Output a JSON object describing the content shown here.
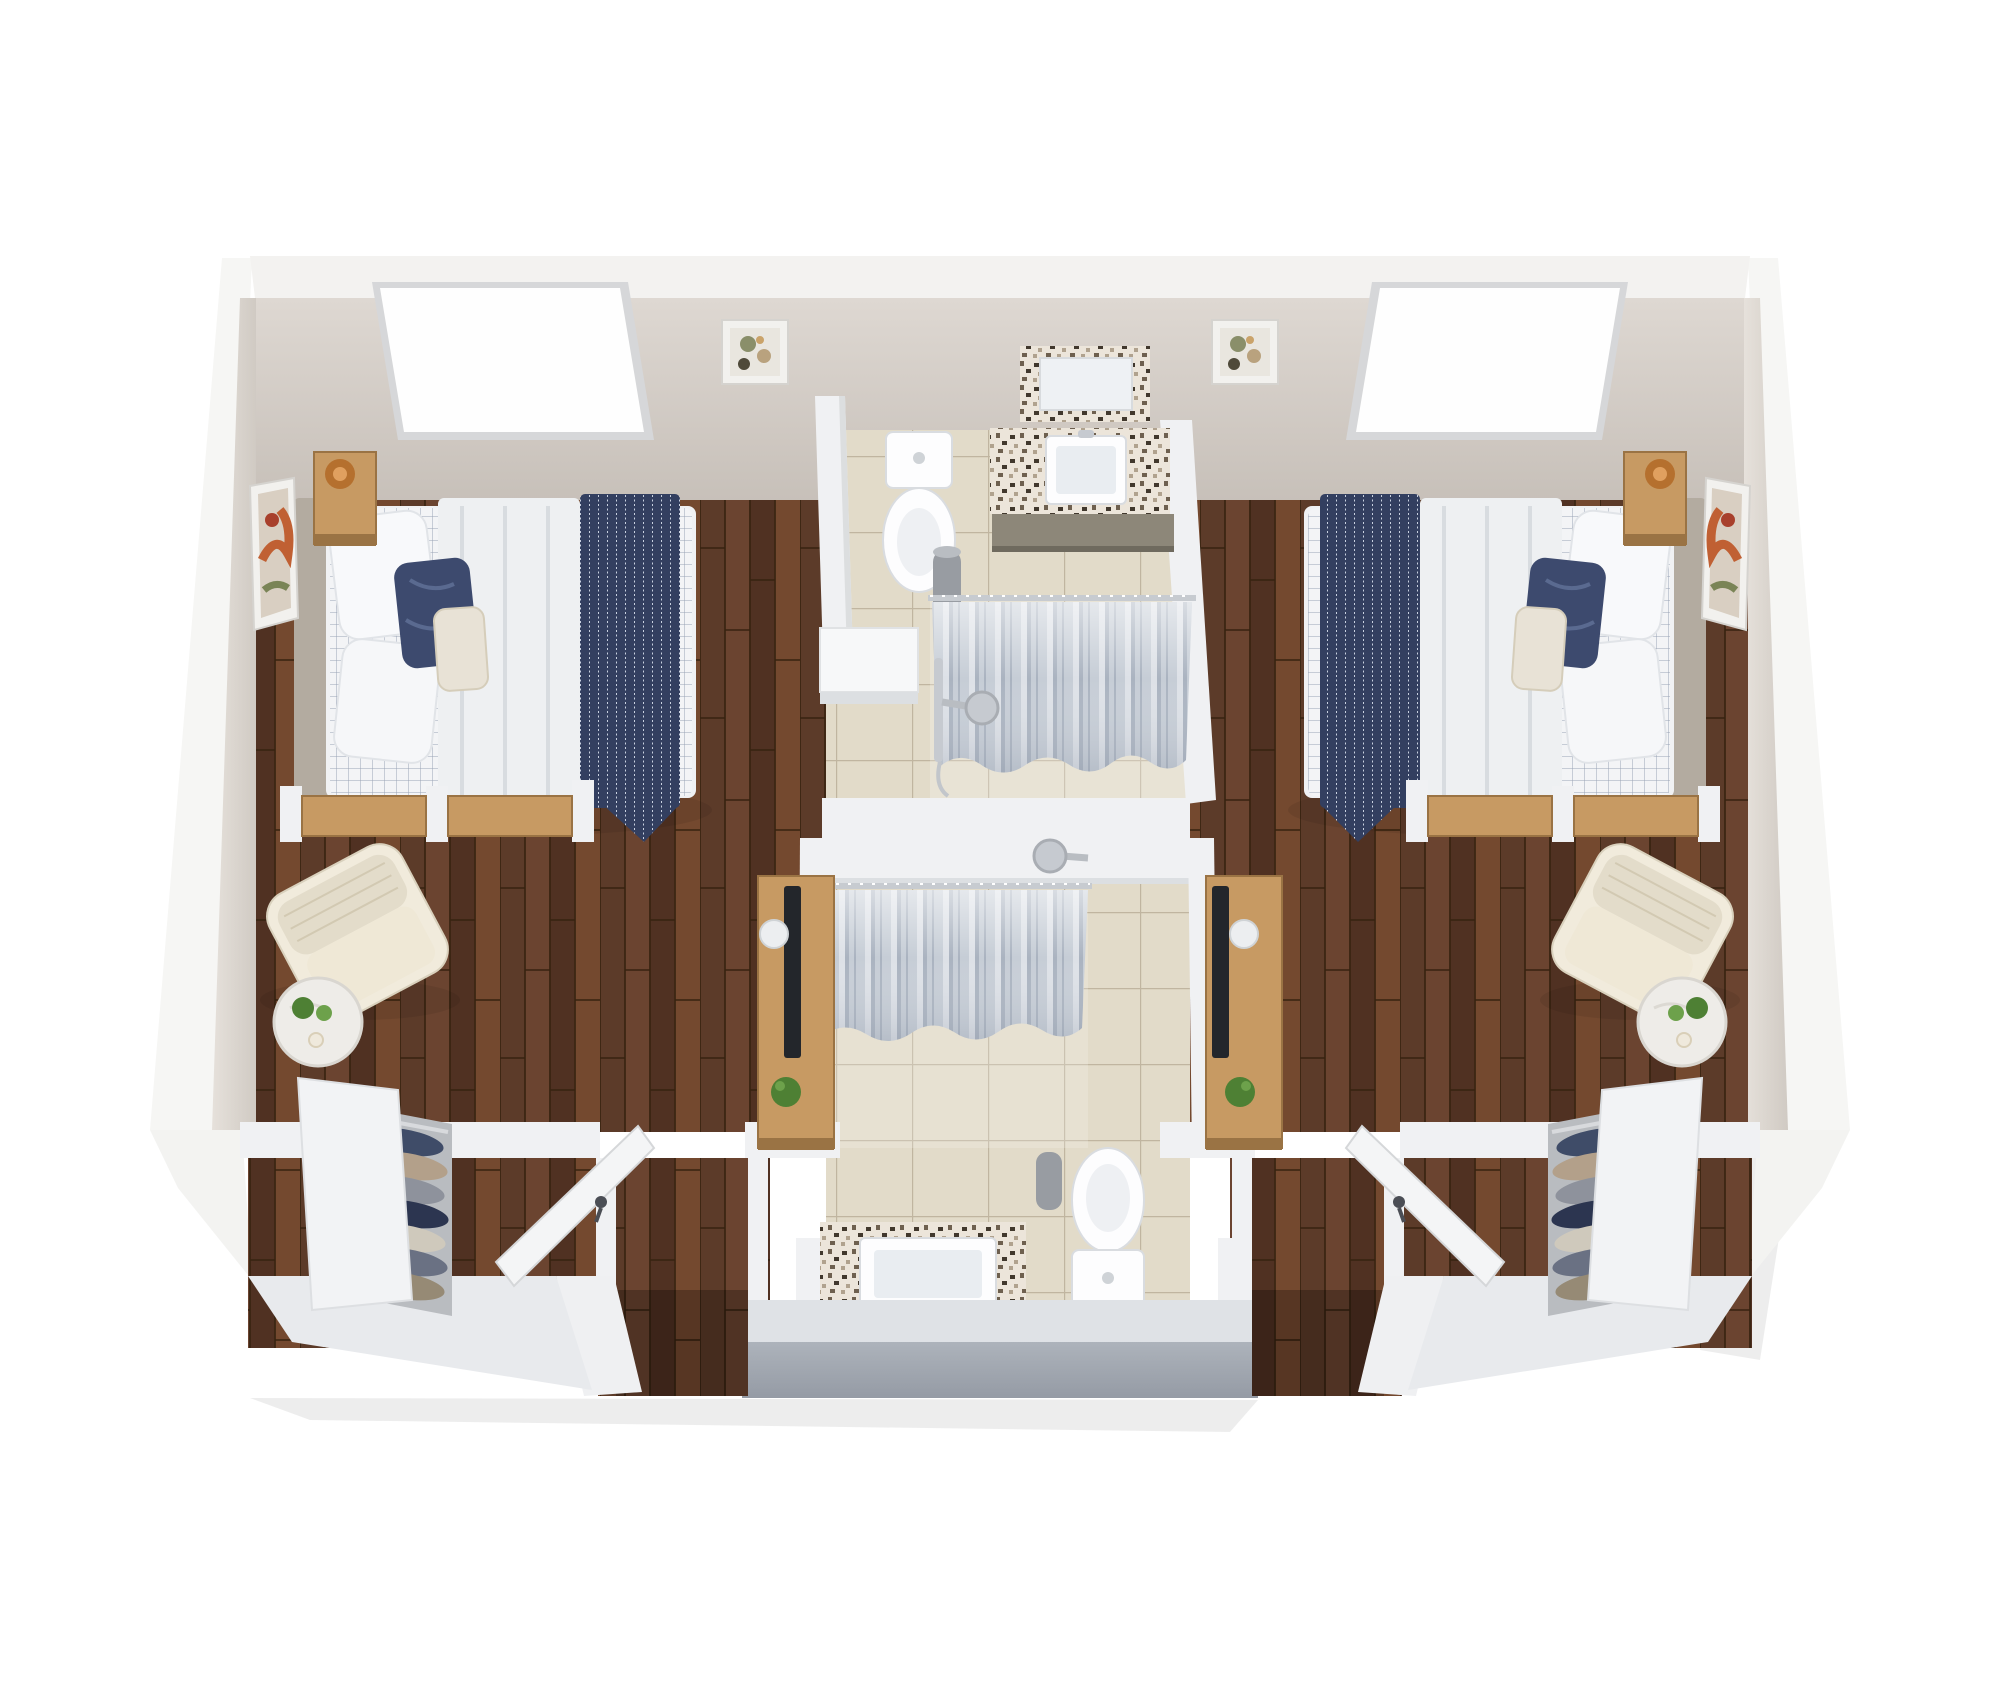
{
  "meta": {
    "description": "Top-down 3D dollhouse render of a mirrored two-bedroom companion suite floor plan on a white background",
    "view": "isometric top-down, no visible text or labels"
  },
  "colors": {
    "outer_white": "#f6f6f4",
    "wall_top": "#f3f2f0",
    "partition_white": "#f0f1f3",
    "wall_face_top": "#ded8d2",
    "wall_face_bottom": "#c6bfb8",
    "wall_side_light": "#e6e1db",
    "wall_side_dark": "#d0cac3",
    "wood_a": "#5c3b29",
    "wood_b": "#6b4430",
    "wood_c": "#503122",
    "wood_d": "#74492f",
    "wood_seam": "#36220f",
    "tile": "#e2dbc9",
    "tile_grout": "#c0b5a0",
    "gray_front_top": "#adb3bb",
    "gray_front_bottom": "#959ba5",
    "band_white": "#dfe2e6",
    "curtain_base": "#c6cdd6",
    "curtain_light": "#dde1e7",
    "curtain_shadow": "#aab3c0",
    "navy": "#333f60",
    "navy_stripe": "#c9d1e0",
    "plaid_bg": "#f3f4f6",
    "plaid_line": "#9aa3b5",
    "white_linen": "#eef0f2",
    "headboard": "#b3aba0",
    "wood_furniture_top": "#c79a63",
    "wood_furniture_front": "#9a7344",
    "copper": "#b5702e",
    "copper_light": "#e0a05f",
    "cream_chair": "#f1ebdc",
    "cream_chair_shadow": "#d9d1bd",
    "marble": "#eeece8",
    "plant_green": "#4e8034",
    "plant_green_light": "#6da14b",
    "tv_black": "#23262b",
    "mosaic_bg": "#ece5da",
    "speckle_dark": "#41382d",
    "speckle_mid": "#6e604f",
    "speckle_light": "#b0a28e",
    "cabinet_taupe": "#8d8779",
    "fixture_white": "#fdfdfe",
    "fixture_shadow": "#d9dce0",
    "chrome": "#c6cad0",
    "bin_gray": "#989ca2",
    "art_frame": "#f2f1ee",
    "door_white": "#f4f5f6",
    "handle_dark": "#4b4e55",
    "clothes_palette": [
      "#3f4c68",
      "#b3a08a",
      "#8e929c",
      "#2c3550",
      "#cfc9bc",
      "#6a7183",
      "#968a75"
    ]
  },
  "scene": {
    "structure": {
      "north_wall": "white band with beige inner face",
      "skylight_openings": 2,
      "floors": [
        "dark walnut plank (bedrooms, closets, entries)",
        "beige ceramic tile (bathroom core)"
      ],
      "entry_openings": [
        "bottom-left corridor",
        "bottom-right corridor"
      ]
    },
    "left_bedroom": {
      "furniture": [
        "bed with gray headboard",
        "white + navy plaid duvet",
        "white folded blanket",
        "navy striped throw",
        "two white pillows",
        "navy accent pillow",
        "tan lumbar pillow",
        "nightstand with copper lamp",
        "abstract art on west wall",
        "small abstract art on north wall",
        "skylight window",
        "two tan bench seats with white posts",
        "cream armchair",
        "round marble side table with plants and candle",
        "media console with TV, plate and plant",
        "closet with hanging clothes",
        "open white entry door with dark handle"
      ]
    },
    "right_bedroom": {
      "furniture": [
        "mirrored copy of left bedroom: bed, plaid duvet, navy throw, pillows, nightstand with copper lamp, wall art x2, skylight window, bench seats, cream armchair, marble side table, media console with TV, closet with clothes, open entry door"
      ]
    },
    "top_bathroom": {
      "fixtures": [
        "toilet (top view)",
        "mosaic-framed mirror",
        "mosaic counter with white vessel sink and faucet",
        "taupe vanity cabinet",
        "gray waste bin",
        "shower with rail, gray pleated curtain, slide bar and shower head"
      ]
    },
    "bottom_bathroom": {
      "fixtures": [
        "mosaic counter with white vessel sink",
        "toilet (top view)",
        "gray waste bin",
        "shower with rail, gray pleated curtain and wall-mounted shower head"
      ]
    }
  }
}
